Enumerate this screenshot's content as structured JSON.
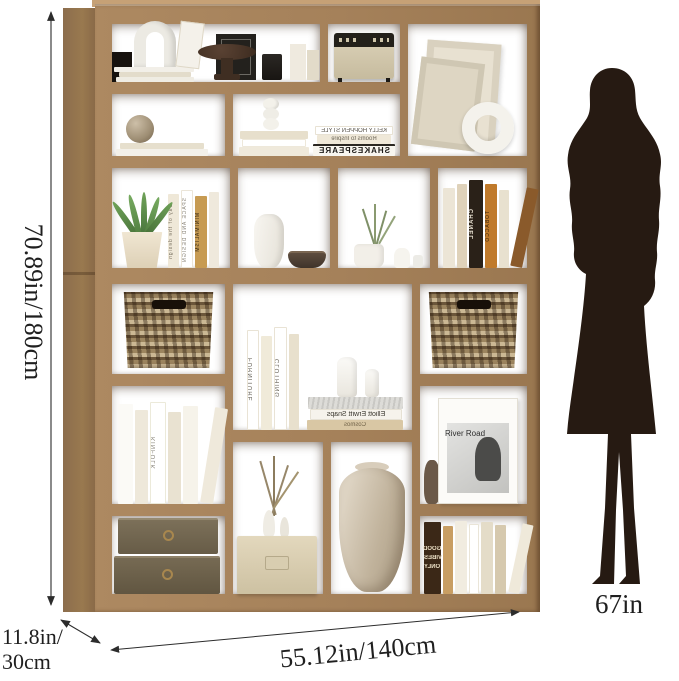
{
  "annotations": {
    "height_label": "70.89in/180cm",
    "depth_label_line1": "11.8in/",
    "depth_label_line2": "30cm",
    "width_label": "55.12in/140cm",
    "person_height_label": "67in",
    "line_color": "#2c2c2c",
    "text_color": "#1f1f1f"
  },
  "shelf": {
    "wood_color": "#a5815a",
    "wood_side_color": "#8c6d4d",
    "basket_color": "#9c855f",
    "spines": {
      "kelly_hoppen": "KELLY HOPPEN STYLE",
      "rooms_to_inspire": "Rooms to Inspire",
      "shakespeare": "SHAKESPEARE",
      "day_of_design": "Day of the design",
      "space_and_design": "SPACE AND DESIGN",
      "minimalism": "MINIMALISM",
      "chanel": "CHANEL",
      "tobacco": "TOBACCO",
      "furniture": "FURNITURE",
      "clothing": "CLOTHING",
      "elliott": "Elliott Erwitt Snaps",
      "cosmos": "Cosmos",
      "kinfolk": "KINFOLK",
      "river_road": "River Road",
      "good_vibes_1": "GOOD",
      "good_vibes_2": "VIBES",
      "good_vibes_3": "ONLY"
    }
  },
  "figure": {
    "icon": "woman-silhouette",
    "color": "#261a12"
  }
}
